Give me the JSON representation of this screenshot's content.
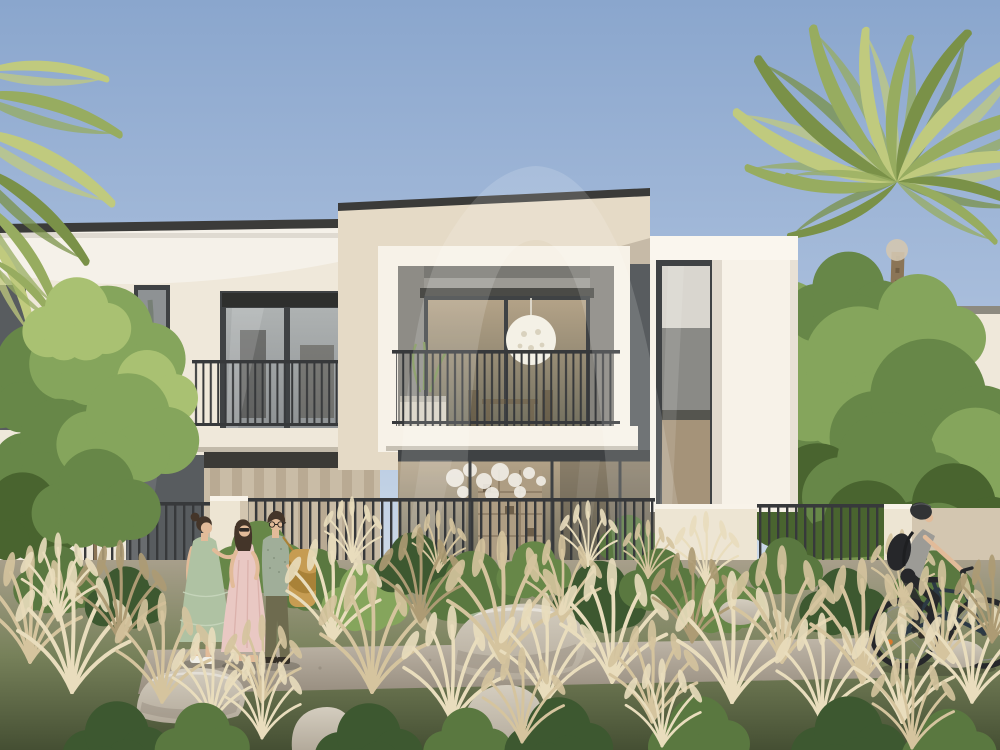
{
  "scene": {
    "setting": "architectural rendering of modern two-storey townhouses with balconies behind a landscaped desert garden",
    "sky": "clear pale-blue sky",
    "landmarks": [
      "palm-fronds-top-left",
      "palm-tree-right",
      "garden-tree-left",
      "perimeter-fence",
      "wild-grass-garden",
      "boulders",
      "walkway",
      "background-villa-right"
    ],
    "people": [
      {
        "name": "woman-in-sage-dress",
        "position": "left",
        "attire": "sage tiered midi dress, white sneakers, hair bun"
      },
      {
        "name": "woman-in-pink-dress",
        "position": "left-center",
        "attire": "blush pink midi dress, sunglasses"
      },
      {
        "name": "man-with-shoulder-bag",
        "position": "left-center",
        "attire": "sage shirt, olive trousers, mustard tote bag, glasses"
      }
    ],
    "cyclist": {
      "name": "cyclist-with-helmet",
      "position": "right",
      "attire": "grey top, black leggings, dark helmet, black backpack",
      "action": "riding right"
    }
  },
  "watermark": {
    "label": "monogram-A-watermark",
    "opacity": "0.15"
  },
  "colors": {
    "sky_top": "#8AA6CD",
    "sky_mid": "#A9BEDC",
    "sky_low": "#CBD9E8",
    "sky_horizon": "#E9EDF0",
    "facade_cream": "#EFE8DA",
    "facade_warm": "#E5DAC6",
    "facade_bright": "#F7F2E8",
    "facade_shade": "#CEC1AC",
    "roof_cap": "#3B3B39",
    "frame_dark": "#3F4244",
    "glass_dark": "#585C5F",
    "glass_mid": "#8E9294",
    "glass_light": "#AEB2B2",
    "glass_warm": "#A89D89",
    "interior_warm": "#B3A287",
    "interior_dark": "#73705F",
    "railing": "#37393B",
    "pendant": "#F4F1E6",
    "curtain_light": "#DBCEB8",
    "curtain_dark": "#C9BAA2",
    "wall_low": "#EDE5D3",
    "wall_low_shade": "#D3C6B0",
    "lawn": "#78944F",
    "tree_dark": "#49642F",
    "tree_mid": "#678748",
    "tree_light": "#85A55C",
    "tree_pale": "#A9C172",
    "palm_dark": "#7A9148",
    "palm_green": "#97AC60",
    "palm_light": "#C0CA7E",
    "trunk": "#8B7557",
    "trunk_dark": "#6A5940",
    "grass_tan": "#D5C49E",
    "grass_light": "#E9DDBD",
    "grass_dark": "#AD9B74",
    "path_light": "#BFB6A8",
    "path_dark": "#978D7F",
    "ground_top": "#A89F8B",
    "ground_mid": "#77815A",
    "ground_bot": "#454F33",
    "rock_light": "#D4CDBF",
    "rock_mid": "#B3AA9B",
    "rock_dark": "#8E8577",
    "shrub_dark": "#3D5830",
    "shrub_mid": "#5A7840",
    "skin": "#E2BB99",
    "hair": "#443529",
    "dress_sage": "#AFC2A3",
    "dress_sage_trim": "#C8D6BD",
    "dress_pink": "#E9C8C3",
    "dress_pink_fold": "#D8AEA8",
    "shirt_sage": "#A0AE99",
    "pants_olive": "#6E6B4F",
    "bag": "#C69C52",
    "bag_dark": "#A98238",
    "shoe_white": "#F1EFE8",
    "shoe_dark": "#332E26",
    "cyclist_gray": "#9C9B96",
    "cyclist_black": "#26272A",
    "helmet": "#313335",
    "bike": "#2C3944",
    "watermark": "#FFFFFF",
    "reflector": "#D9792E"
  }
}
